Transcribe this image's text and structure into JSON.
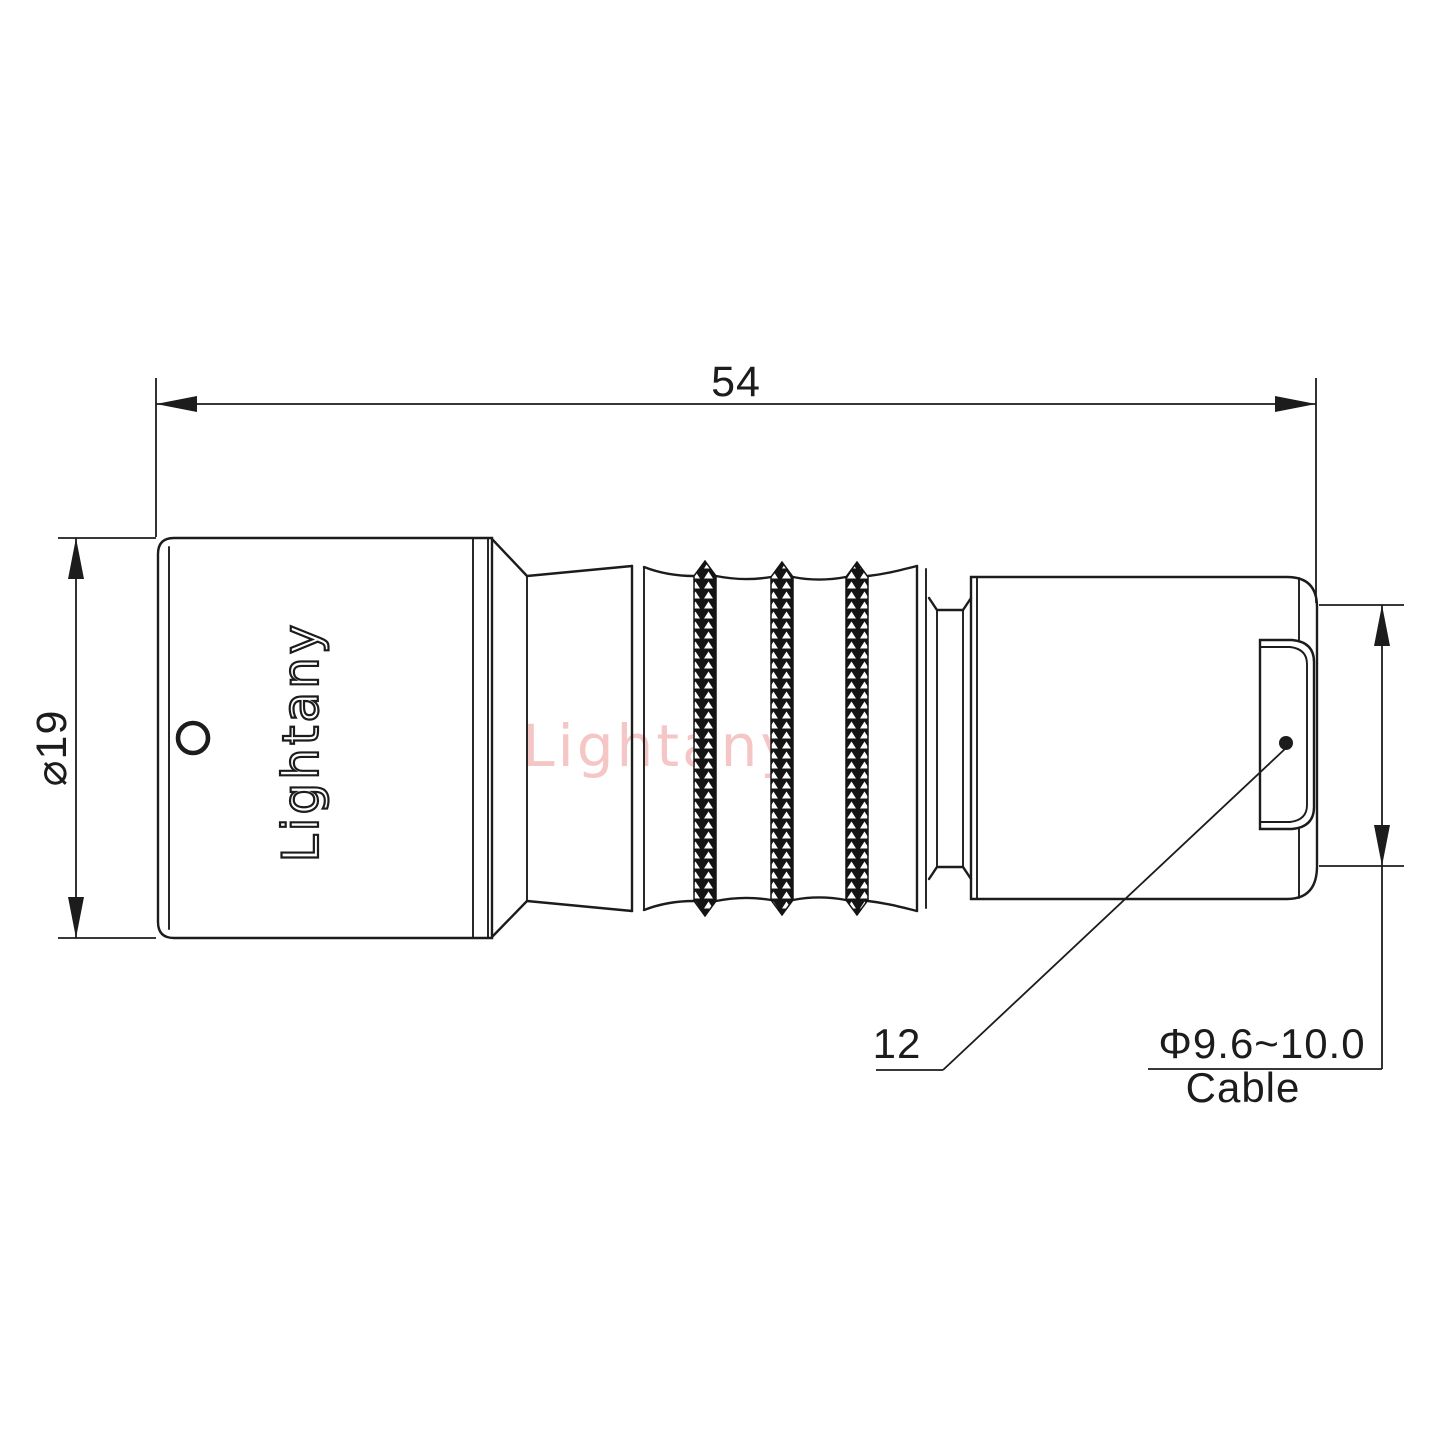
{
  "drawing_type": "connector technical drawing",
  "dimensions": {
    "overall_length": "54",
    "body_diameter": "⌀19",
    "boot_length": "12",
    "cable_diameter": "Φ9.6~10.0",
    "cable_label": "Cable"
  },
  "branding": {
    "body_logo": "Lightany",
    "watermark": "Lightany"
  },
  "colors": {
    "line": "#1c1c1c",
    "watermark": "#ec9898",
    "background": "#ffffff"
  }
}
